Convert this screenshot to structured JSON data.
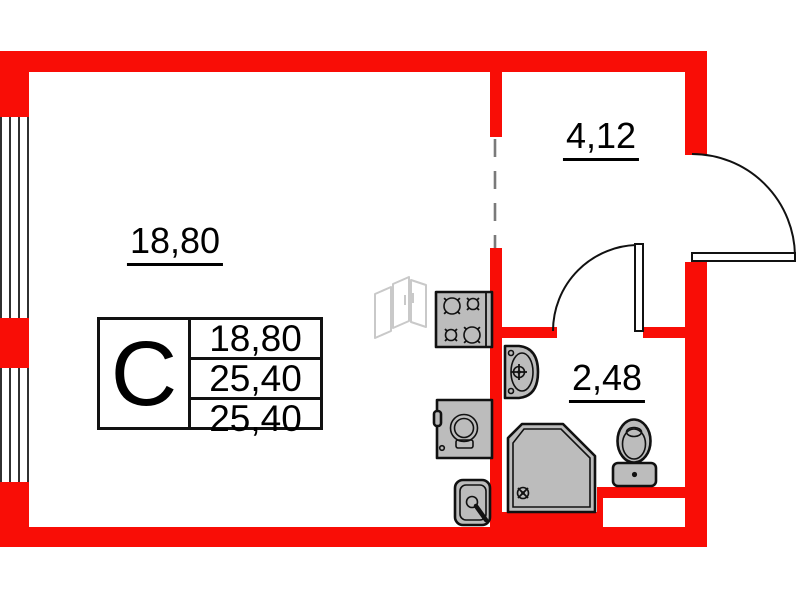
{
  "rooms": {
    "main": {
      "area": "18,80"
    },
    "hallway": {
      "area": "4,12"
    },
    "bathroom": {
      "area": "2,48"
    }
  },
  "info_table": {
    "type": "С",
    "values": [
      "18,80",
      "25,40",
      "25,40"
    ]
  },
  "icons": [
    "stove-icon",
    "washing-machine-icon",
    "kitchen-sink-icon",
    "radiator-icon",
    "bathroom-sink-icon",
    "shower-icon",
    "toilet-icon",
    "entrance-door-arc",
    "bathroom-door-arc",
    "window-symbol"
  ],
  "colors": {
    "wall": "#f90d06",
    "fixture": "#bcbcbc",
    "line": "#111111",
    "radiator": "#c9c9c9"
  }
}
